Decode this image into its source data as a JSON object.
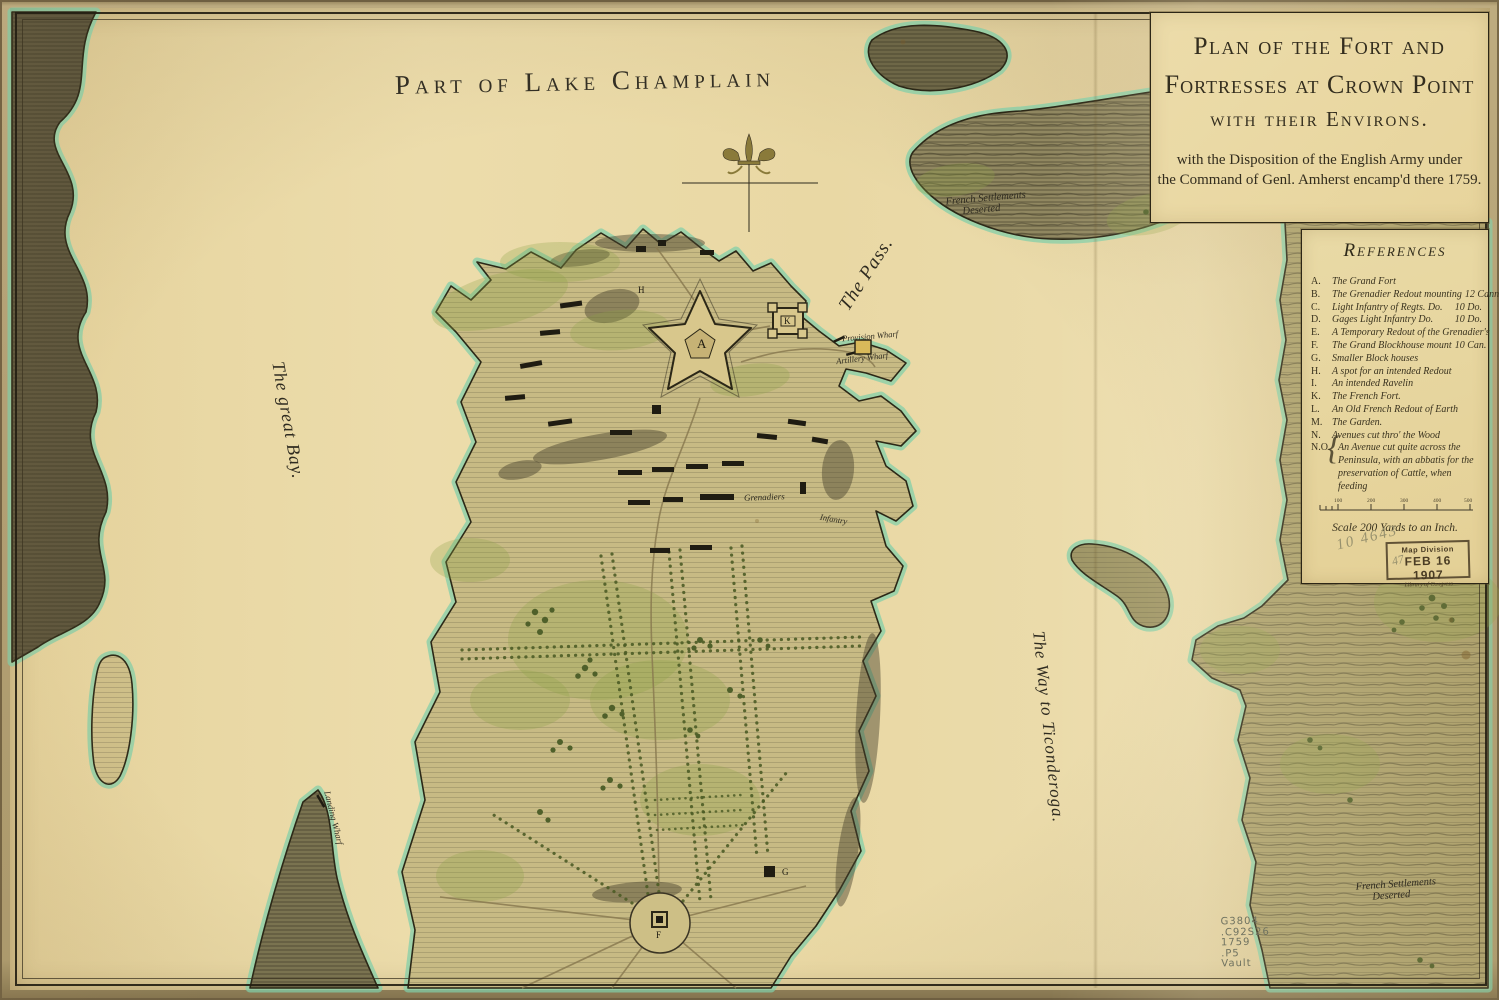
{
  "lake_title": "Part of Lake Champlain",
  "cartouche": {
    "line1": "Plan of the Fort and",
    "line2": "Fortresses at Crown Point",
    "line3": "with their Environs.",
    "sub1": "with the Disposition of the English Army under",
    "sub2": "the Command of Genl. Amherst encamp'd there 1759."
  },
  "references": {
    "title": "References",
    "items": [
      {
        "letter": "A.",
        "text": "The Grand Fort",
        "value": ""
      },
      {
        "letter": "B.",
        "text": "The Grenadier Redout mounting",
        "value": "12 Cann."
      },
      {
        "letter": "C.",
        "text": "Light Infantry of Regts. Do.",
        "value": "10 Do."
      },
      {
        "letter": "D.",
        "text": "Gages Light Infantry Do.",
        "value": "10 Do."
      },
      {
        "letter": "E.",
        "text": "A Temporary Redout of the Grenadier's",
        "value": ""
      },
      {
        "letter": "F.",
        "text": "The Grand Blockhouse mount",
        "value": "10 Can."
      },
      {
        "letter": "G.",
        "text": "Smaller Block houses",
        "value": ""
      },
      {
        "letter": "H.",
        "text": "A spot for an intended Redout",
        "value": ""
      },
      {
        "letter": "I.",
        "text": "An intended Ravelin",
        "value": ""
      },
      {
        "letter": "K.",
        "text": "The French Fort.",
        "value": ""
      },
      {
        "letter": "L.",
        "text": "An Old French Redout of Earth",
        "value": ""
      },
      {
        "letter": "M.",
        "text": "The Garden.",
        "value": ""
      },
      {
        "letter": "N.",
        "text": "Avenues cut thro' the Wood",
        "value": ""
      },
      {
        "letter": "N.O.",
        "text": "An Avenue cut quite across the Peninsula, with an abbatis for the preservation of Cattle, when feeding",
        "value": ""
      }
    ],
    "scale_caption": "Scale 200 Yards to an Inch.",
    "scale_ticks": [
      "100",
      "200",
      "300",
      "400",
      "500"
    ]
  },
  "map_labels": {
    "the_pass": "The Pass.",
    "great_bay": "The great Bay.",
    "way_to_ticonderoga": "The Way to Ticonderoga.",
    "french_settlements_north_a": "French Settlements",
    "french_settlements_north_b": "Deserted",
    "french_settlements_south_a": "French Settlements",
    "french_settlements_south_b": "Deserted",
    "provision_wharf": "Provision Wharf",
    "artillery_wharf": "Artillery Wharf",
    "landing_wharf": "Landing Wharf",
    "grenadiers": "Grenadiers",
    "infantry": "Infantry"
  },
  "letters": {
    "a": "A",
    "k": "K",
    "f": "F",
    "g": "G",
    "h": "H"
  },
  "annotations": {
    "pencil_number": "10 4643",
    "pencil_number_2": "47",
    "call_number_1": "G3804",
    "call_number_2": ".C92S26",
    "call_number_3": "1759",
    "call_number_4": ".P5",
    "call_number_5": "Vault"
  },
  "stamp": {
    "line1": "Map Division",
    "line2": "FEB 16 1907",
    "line3": "Library of Congress"
  },
  "colors": {
    "paper": "#e9d8a4",
    "land": "#c7ba84",
    "shore_teal": "#7fcfa9",
    "ink": "#2e2a1a"
  }
}
